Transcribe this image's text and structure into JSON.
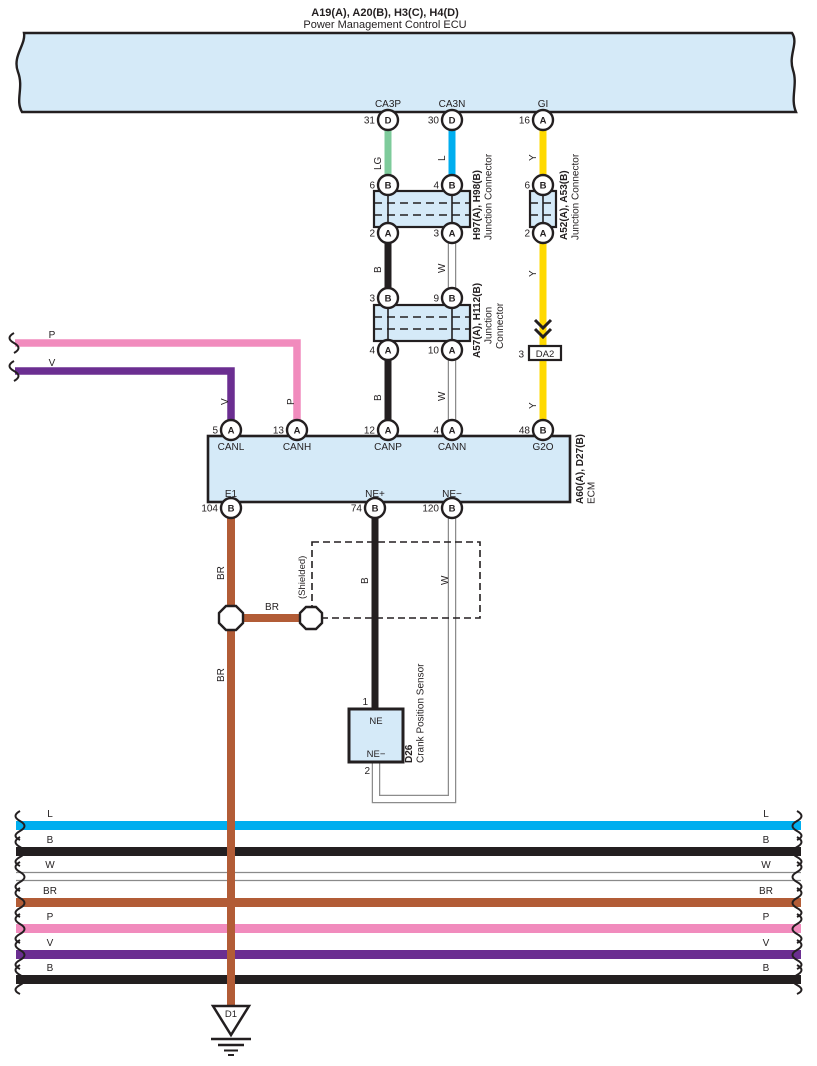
{
  "top": {
    "title1": "A19(A), A20(B), H3(C), H4(D)",
    "title2": "Power Management Control ECU",
    "pins": [
      {
        "label": "CA3P",
        "num": "31",
        "letter": "D"
      },
      {
        "label": "CA3N",
        "num": "30",
        "letter": "D"
      },
      {
        "label": "GI",
        "num": "16",
        "letter": "A"
      }
    ]
  },
  "wires": {
    "lg": "LG",
    "l": "L",
    "y": "Y",
    "b": "B",
    "w": "W",
    "br": "BR",
    "p": "P",
    "v": "V",
    "shielded": "(Shielded)"
  },
  "j1": {
    "name": "H97(A), H98(B)",
    "type": "Junction Connector",
    "t1num": "6",
    "t1letter": "B",
    "t2num": "4",
    "t2letter": "B",
    "b1num": "2",
    "b1letter": "A",
    "b2num": "3",
    "b2letter": "A"
  },
  "j2": {
    "name": "A52(A), A53(B)",
    "type": "Junction Connector",
    "tnum": "6",
    "tletter": "B",
    "bnum": "2",
    "bletter": "A"
  },
  "j3": {
    "name": "A57(A), H112(B)",
    "type1": "Junction",
    "type2": "Connector",
    "t1num": "3",
    "t1letter": "B",
    "t2num": "9",
    "t2letter": "B",
    "b1num": "4",
    "b1letter": "A",
    "b2num": "10",
    "b2letter": "A"
  },
  "da2": {
    "num": "3",
    "label": "DA2"
  },
  "ecm": {
    "name": "A60(A), D27(B)",
    "type": "ECM",
    "top": [
      {
        "num": "5",
        "letter": "A",
        "label": "CANL"
      },
      {
        "num": "13",
        "letter": "A",
        "label": "CANH"
      },
      {
        "num": "12",
        "letter": "A",
        "label": "CANP"
      },
      {
        "num": "4",
        "letter": "A",
        "label": "CANN"
      },
      {
        "num": "48",
        "letter": "B",
        "label": "G2O"
      }
    ],
    "bottom": [
      {
        "num": "104",
        "letter": "B",
        "label": "E1"
      },
      {
        "num": "74",
        "letter": "B",
        "label": "NE+"
      },
      {
        "num": "120",
        "letter": "B",
        "label": "NE−"
      }
    ]
  },
  "sensor": {
    "name": "D26",
    "type": "Crank Position Sensor",
    "pin1": "1",
    "pin2": "2",
    "top": "NE",
    "bottom": "NE−"
  },
  "ground": {
    "label": "D1"
  },
  "bands": [
    {
      "label": "L",
      "color": "#00AEEF"
    },
    {
      "label": "B",
      "color": "#231F20"
    },
    {
      "label": "W",
      "color": "#FFFFFF"
    },
    {
      "label": "BR",
      "color": "#B25C36"
    },
    {
      "label": "P",
      "color": "#F18BBD"
    },
    {
      "label": "V",
      "color": "#6B2E91"
    },
    {
      "label": "B",
      "color": "#231F20"
    }
  ],
  "colors": {
    "panel": "#D5EAF8",
    "lg": "#7ECB9B",
    "l": "#00AEEF",
    "y": "#FFD900",
    "b": "#231F20",
    "w": "#FFFFFF",
    "br": "#B25C36",
    "p": "#F18BBD",
    "v": "#6B2E91"
  }
}
